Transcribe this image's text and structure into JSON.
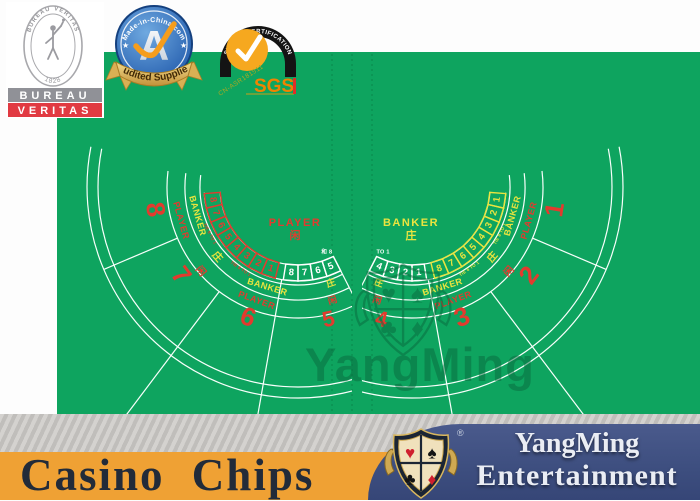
{
  "badges": {
    "bureau_veritas": {
      "arc_top": "BUREAU VERITAS",
      "arc_bottom": "1828",
      "bar1": "BUREAU",
      "bar2": "VERITAS"
    },
    "made_in_china": {
      "arc": "Made-in-China.com",
      "letter": "A",
      "banner": "Audited Supplier",
      "star_left": "★",
      "star_right": "★"
    },
    "sgs": {
      "arch": "SYSTEM CERTIFICATION",
      "cert_no": "CN-ASR181511",
      "name": "SGS"
    }
  },
  "felt": {
    "color": "#0ea45f",
    "line_color": "#f8fffb",
    "red": "#e23b2e",
    "yellow": "#eae43f",
    "dash_color": "rgba(0,70,35,0.32)",
    "watermark": {
      "text": "YangMing",
      "suits": [
        "♥",
        "♠",
        "♣",
        "♦"
      ]
    },
    "fans": [
      {
        "side": "left",
        "hub": [
          298,
          187
        ],
        "mirror": 1,
        "center": [
          295,
          226
        ],
        "center_label": {
          "line1": "PLAYER",
          "line2": "闲",
          "color": "red"
        },
        "arc_boxes": {
          "color": "red",
          "numbers": [
            "1",
            "2",
            "3",
            "4",
            "5",
            "6",
            "7",
            "8"
          ]
        },
        "row_boxes": {
          "color": "white",
          "numbers": [
            "5",
            "6",
            "7",
            "8"
          ]
        },
        "row_label": "和 8",
        "tie_text": "TIE 8 TO 1",
        "ring_labels": [
          {
            "t": "BANKER",
            "a": 107,
            "r": 105,
            "c": "yellow",
            "s": 9
          },
          {
            "t": "PLAYER",
            "a": 110,
            "r": 121,
            "c": "red",
            "s": 9
          },
          {
            "t": "BANKER",
            "a": 164,
            "r": 105,
            "c": "yellow",
            "s": 9
          },
          {
            "t": "PLAYER",
            "a": 164,
            "r": 122,
            "c": "red",
            "s": 9
          },
          {
            "t": "庄",
            "a": 139,
            "r": 107,
            "c": "yellow",
            "s": 10
          },
          {
            "t": "闲",
            "a": 139,
            "r": 129,
            "c": "red",
            "s": 10
          },
          {
            "t": "庄",
            "a": 71,
            "r": 102,
            "c": "yellow",
            "s": 9
          },
          {
            "t": "闲",
            "a": 73,
            "r": 119,
            "c": "red",
            "s": 9
          }
        ],
        "seat_numbers": [
          {
            "t": "6",
            "a": 111,
            "r": 141,
            "s": 26
          },
          {
            "t": "7",
            "a": 143,
            "r": 148,
            "s": 26
          },
          {
            "t": "8",
            "a": 171,
            "r": 146,
            "s": 26
          },
          {
            "t": "5",
            "a": 77,
            "r": 137,
            "s": 22
          }
        ]
      },
      {
        "side": "right",
        "hub": [
          412,
          187
        ],
        "mirror": -1,
        "center": [
          411,
          226
        ],
        "center_label": {
          "line1": "BANKER",
          "line2": "庄",
          "color": "yellow"
        },
        "arc_boxes": {
          "color": "yellow",
          "numbers": [
            "8",
            "7",
            "6",
            "5",
            "4",
            "3",
            "2",
            "1"
          ]
        },
        "row_boxes": {
          "color": "white",
          "numbers": [
            "4",
            "3",
            "2",
            "1"
          ]
        },
        "row_label": "TO 1",
        "tie_text": "TIE 8 TO 1",
        "ring_labels": [
          {
            "t": "BANKER",
            "a": 107,
            "r": 105,
            "c": "yellow",
            "s": 9
          },
          {
            "t": "PLAYER",
            "a": 110,
            "r": 121,
            "c": "red",
            "s": 9
          },
          {
            "t": "BANKER",
            "a": 164,
            "r": 105,
            "c": "yellow",
            "s": 9
          },
          {
            "t": "PLAYER",
            "a": 164,
            "r": 122,
            "c": "red",
            "s": 9
          },
          {
            "t": "庄",
            "a": 139,
            "r": 107,
            "c": "yellow",
            "s": 10
          },
          {
            "t": "闲",
            "a": 139,
            "r": 129,
            "c": "red",
            "s": 10
          },
          {
            "t": "庄",
            "a": 71,
            "r": 102,
            "c": "yellow",
            "s": 9
          },
          {
            "t": "闲",
            "a": 73,
            "r": 119,
            "c": "red",
            "s": 9
          }
        ],
        "seat_numbers": [
          {
            "t": "3",
            "a": 111,
            "r": 141,
            "s": 26
          },
          {
            "t": "2",
            "a": 143,
            "r": 148,
            "s": 26
          },
          {
            "t": "1",
            "a": 171,
            "r": 146,
            "s": 26
          },
          {
            "t": "4",
            "a": 77,
            "r": 137,
            "s": 22
          }
        ]
      }
    ]
  },
  "footer": {
    "product": "Casino Chips",
    "brand_line1": "YangMing",
    "brand_line2": "Entertainment",
    "registered": "®",
    "shield_suits": [
      "♥",
      "♠",
      "♣",
      "♦"
    ],
    "colors": {
      "orange_bar": "#efa134",
      "navy_panel": "#3e4f80",
      "gold": "#caa54e"
    }
  }
}
